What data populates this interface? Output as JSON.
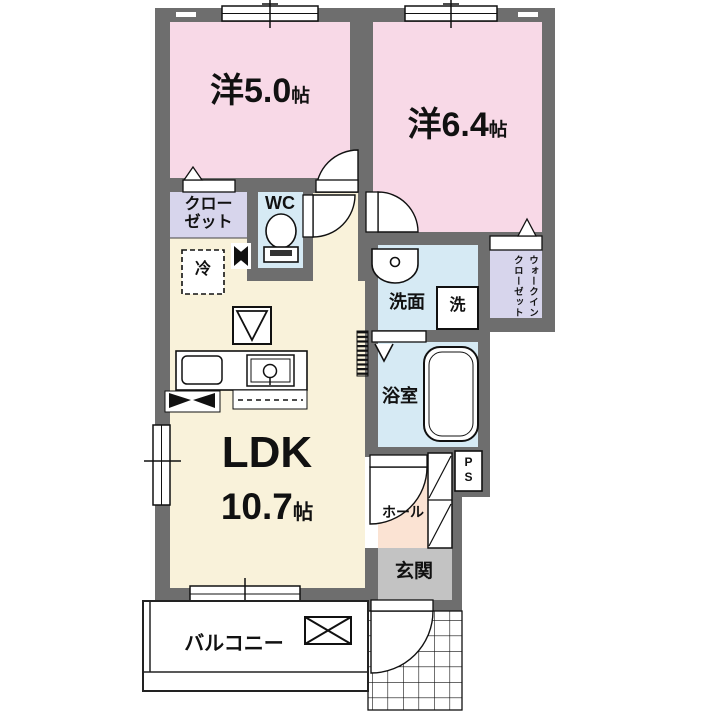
{
  "title": "1LDK floor plan",
  "rooms": {
    "bedroom1": {
      "name": "洋5.0",
      "unit": "帖"
    },
    "bedroom2": {
      "name": "洋6.4",
      "unit": "帖"
    },
    "ldk": {
      "name": "LDK",
      "size": "10.7",
      "unit": "帖"
    },
    "closet": {
      "line1": "クロー",
      "line2": "ゼット"
    },
    "wc": {
      "label": "WC"
    },
    "fridge": {
      "label": "冷"
    },
    "washroom": {
      "label": "洗面"
    },
    "washer": {
      "label": "洗"
    },
    "bathroom": {
      "label": "浴室"
    },
    "wic": {
      "line1": "ウォークイン",
      "line2": "クローゼット"
    },
    "hall": {
      "label": "ホール"
    },
    "entrance": {
      "label": "玄関"
    },
    "balcony": {
      "label": "バルコニー"
    },
    "ps": {
      "label": "PS"
    }
  },
  "colors": {
    "wall": "#6e6e6e",
    "bedroom": "#f8d9e7",
    "ldk": "#f9f2da",
    "wet": "#d6eaf4",
    "closet": "#d7d5ec",
    "hall": "#fbe3d3",
    "entrance": "#c3c3c3",
    "line": "#111111"
  }
}
